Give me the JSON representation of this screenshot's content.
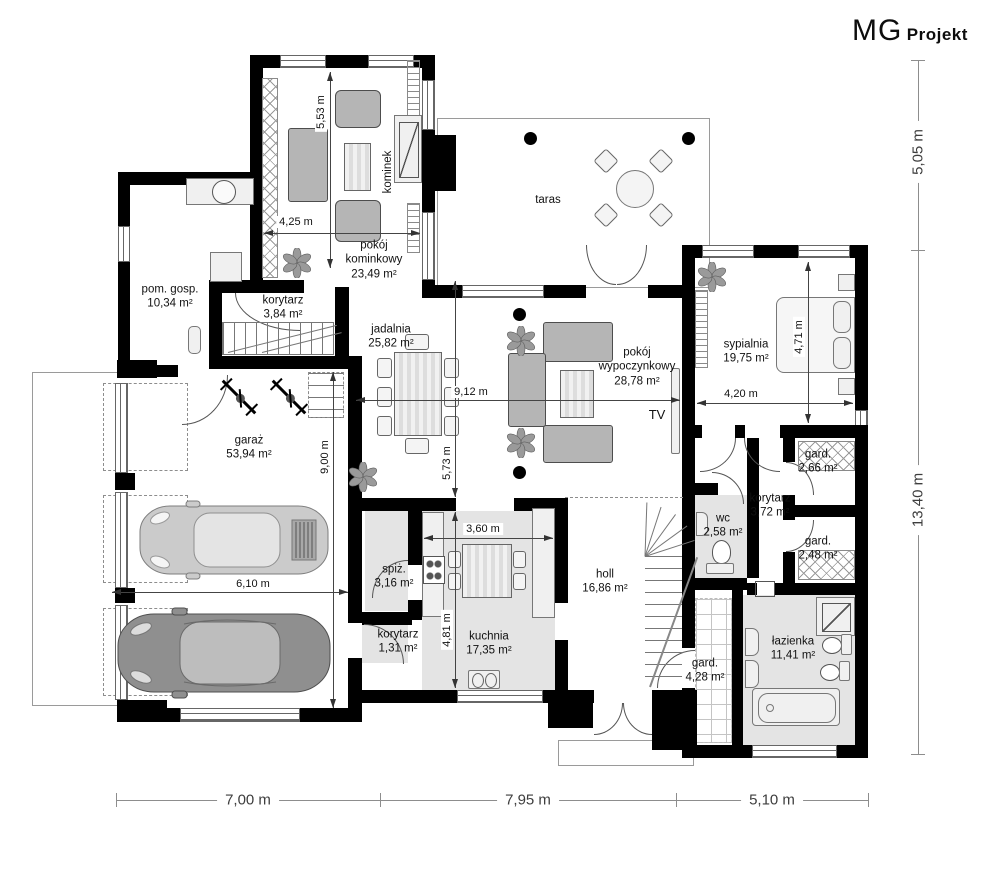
{
  "logo": {
    "mg": "MG",
    "projekt": "Projekt"
  },
  "rooms": {
    "pom_gosp": {
      "name": "pom. gosp.",
      "area": "10,34 m²"
    },
    "korytarz_a": {
      "name": "korytarz",
      "area": "3,84 m²"
    },
    "pokoj_kominkowy": {
      "name": "pokój kominkowy",
      "area": "23,49 m²"
    },
    "jadalnia": {
      "name": "jadalnia",
      "area": "25,82 m²"
    },
    "pokoj_wypoczynkowy": {
      "name": "pokój wypoczynkowy",
      "area": "28,78 m²"
    },
    "sypialnia": {
      "name": "sypialnia",
      "area": "19,75 m²"
    },
    "gard_a": {
      "name": "gard.",
      "area": "2,66 m²"
    },
    "korytarz_b": {
      "name": "korytarz",
      "area": "3,72 m²"
    },
    "gard_b": {
      "name": "gard.",
      "area": "2,48 m²"
    },
    "wc": {
      "name": "wc",
      "area": "2,58 m²"
    },
    "lazienka": {
      "name": "łazienka",
      "area": "11,41 m²"
    },
    "gard_c": {
      "name": "gard.",
      "area": "4,28 m²"
    },
    "holl": {
      "name": "holl",
      "area": "16,86 m²"
    },
    "kuchnia": {
      "name": "kuchnia",
      "area": "17,35 m²"
    },
    "spiz": {
      "name": "spiż.",
      "area": "3,16 m²"
    },
    "korytarz_c": {
      "name": "korytarz",
      "area": "1,31 m²"
    },
    "garaz": {
      "name": "garaż",
      "area": "53,94 m²"
    }
  },
  "labels": {
    "kominek": "kominek",
    "taras": "taras",
    "tv": "TV"
  },
  "dimensions": {
    "bottom": [
      "7,00 m",
      "7,95 m",
      "5,10 m"
    ],
    "right": [
      "5,05 m",
      "13,40 m"
    ],
    "interior": {
      "pokoj_kominkowy_w": "4,25 m",
      "pokoj_kominkowy_h": "5,53 m",
      "salon_w": "9,12 m",
      "jadalnia_h": "5,73 m",
      "kuchnia_w": "3,60 m",
      "kuchnia_h": "4,81 m",
      "garaz_w": "6,10 m",
      "garaz_h": "9,00 m",
      "sypialnia_w": "4,20 m",
      "sypialnia_h": "4,71 m"
    }
  }
}
